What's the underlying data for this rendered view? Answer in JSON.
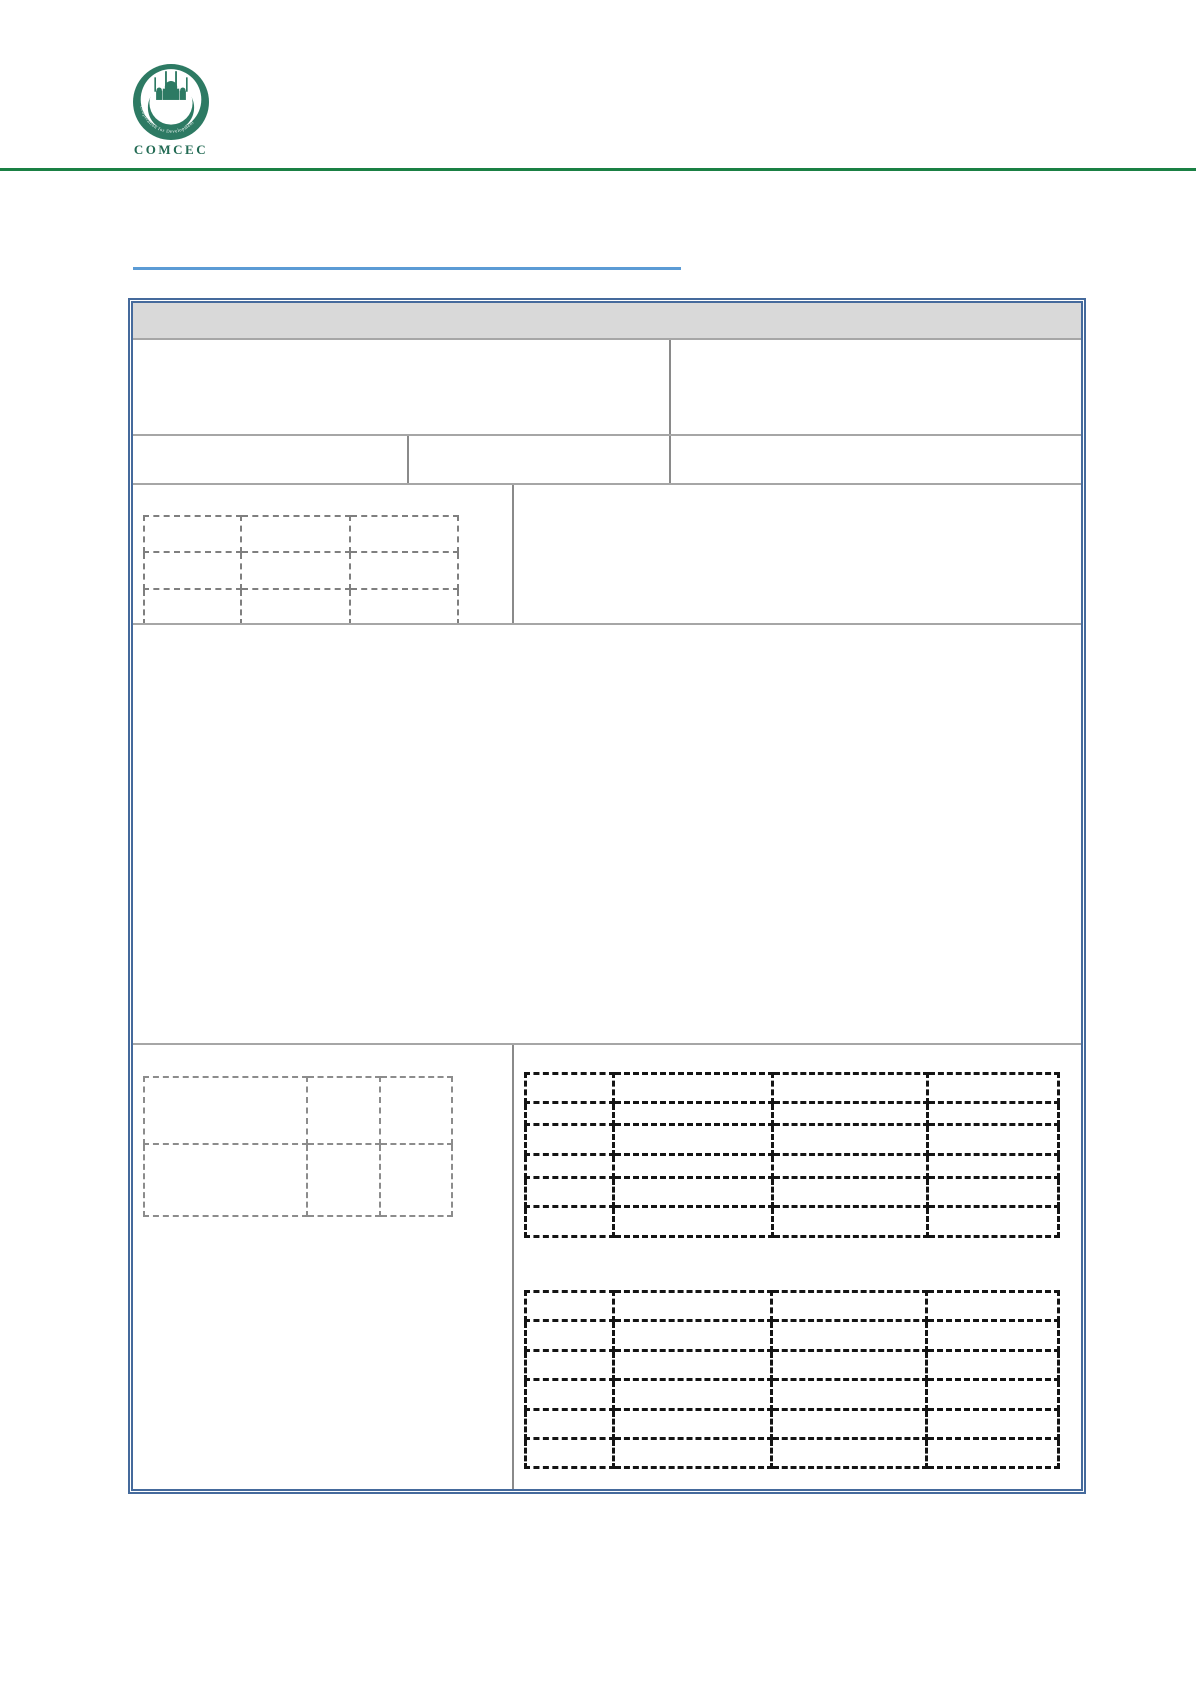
{
  "page": {
    "background": "#ffffff",
    "width": 1196,
    "height": 1692
  },
  "masthead": {
    "logo": {
      "caption": "COMCEC",
      "ring_text": "Cooperation for Development",
      "center_text": "COMCEC",
      "disc_color": "#2d7a63",
      "caption_color": "#236b54"
    },
    "rule_color": "#1a8044"
  },
  "title_link": {
    "text": "",
    "underline_color": "#5b9bd5"
  },
  "form": {
    "outer_border_color": "#456a9c",
    "grid_color": "#a6a6a6",
    "divider_color": "#8a8a8a",
    "header_bar": {
      "fill": "#d9d9d9",
      "label": ""
    },
    "cell_labels": {
      "row1_left": "",
      "row1_right": "",
      "row2_col1": "",
      "row2_col2": "",
      "row2_col3": "",
      "row3_right": "",
      "big_cell": "",
      "bottom_left": "",
      "bottom_right": ""
    }
  },
  "dashed_tables": {
    "upper_left": {
      "style": "gray",
      "border_color": "#7f7f7f",
      "border_width": 2,
      "col_widths": [
        97,
        109,
        108
      ],
      "row_heights": [
        36,
        37,
        35
      ]
    },
    "lower_left": {
      "style": "gray",
      "border_color": "#8c8c8c",
      "border_width": 2,
      "col_widths": [
        163,
        73,
        72
      ],
      "row_heights": [
        67,
        72
      ]
    },
    "right_top": {
      "style": "black",
      "border_color": "#141414",
      "border_width": 3,
      "col_widths": [
        88,
        159,
        155,
        131
      ],
      "row_heights": [
        29,
        22,
        30,
        23,
        29,
        30
      ]
    },
    "right_bottom": {
      "style": "black",
      "border_color": "#141414",
      "border_width": 3,
      "col_widths": [
        88,
        158,
        155,
        132
      ],
      "row_heights": [
        29,
        30,
        29,
        30,
        29,
        29
      ]
    }
  }
}
